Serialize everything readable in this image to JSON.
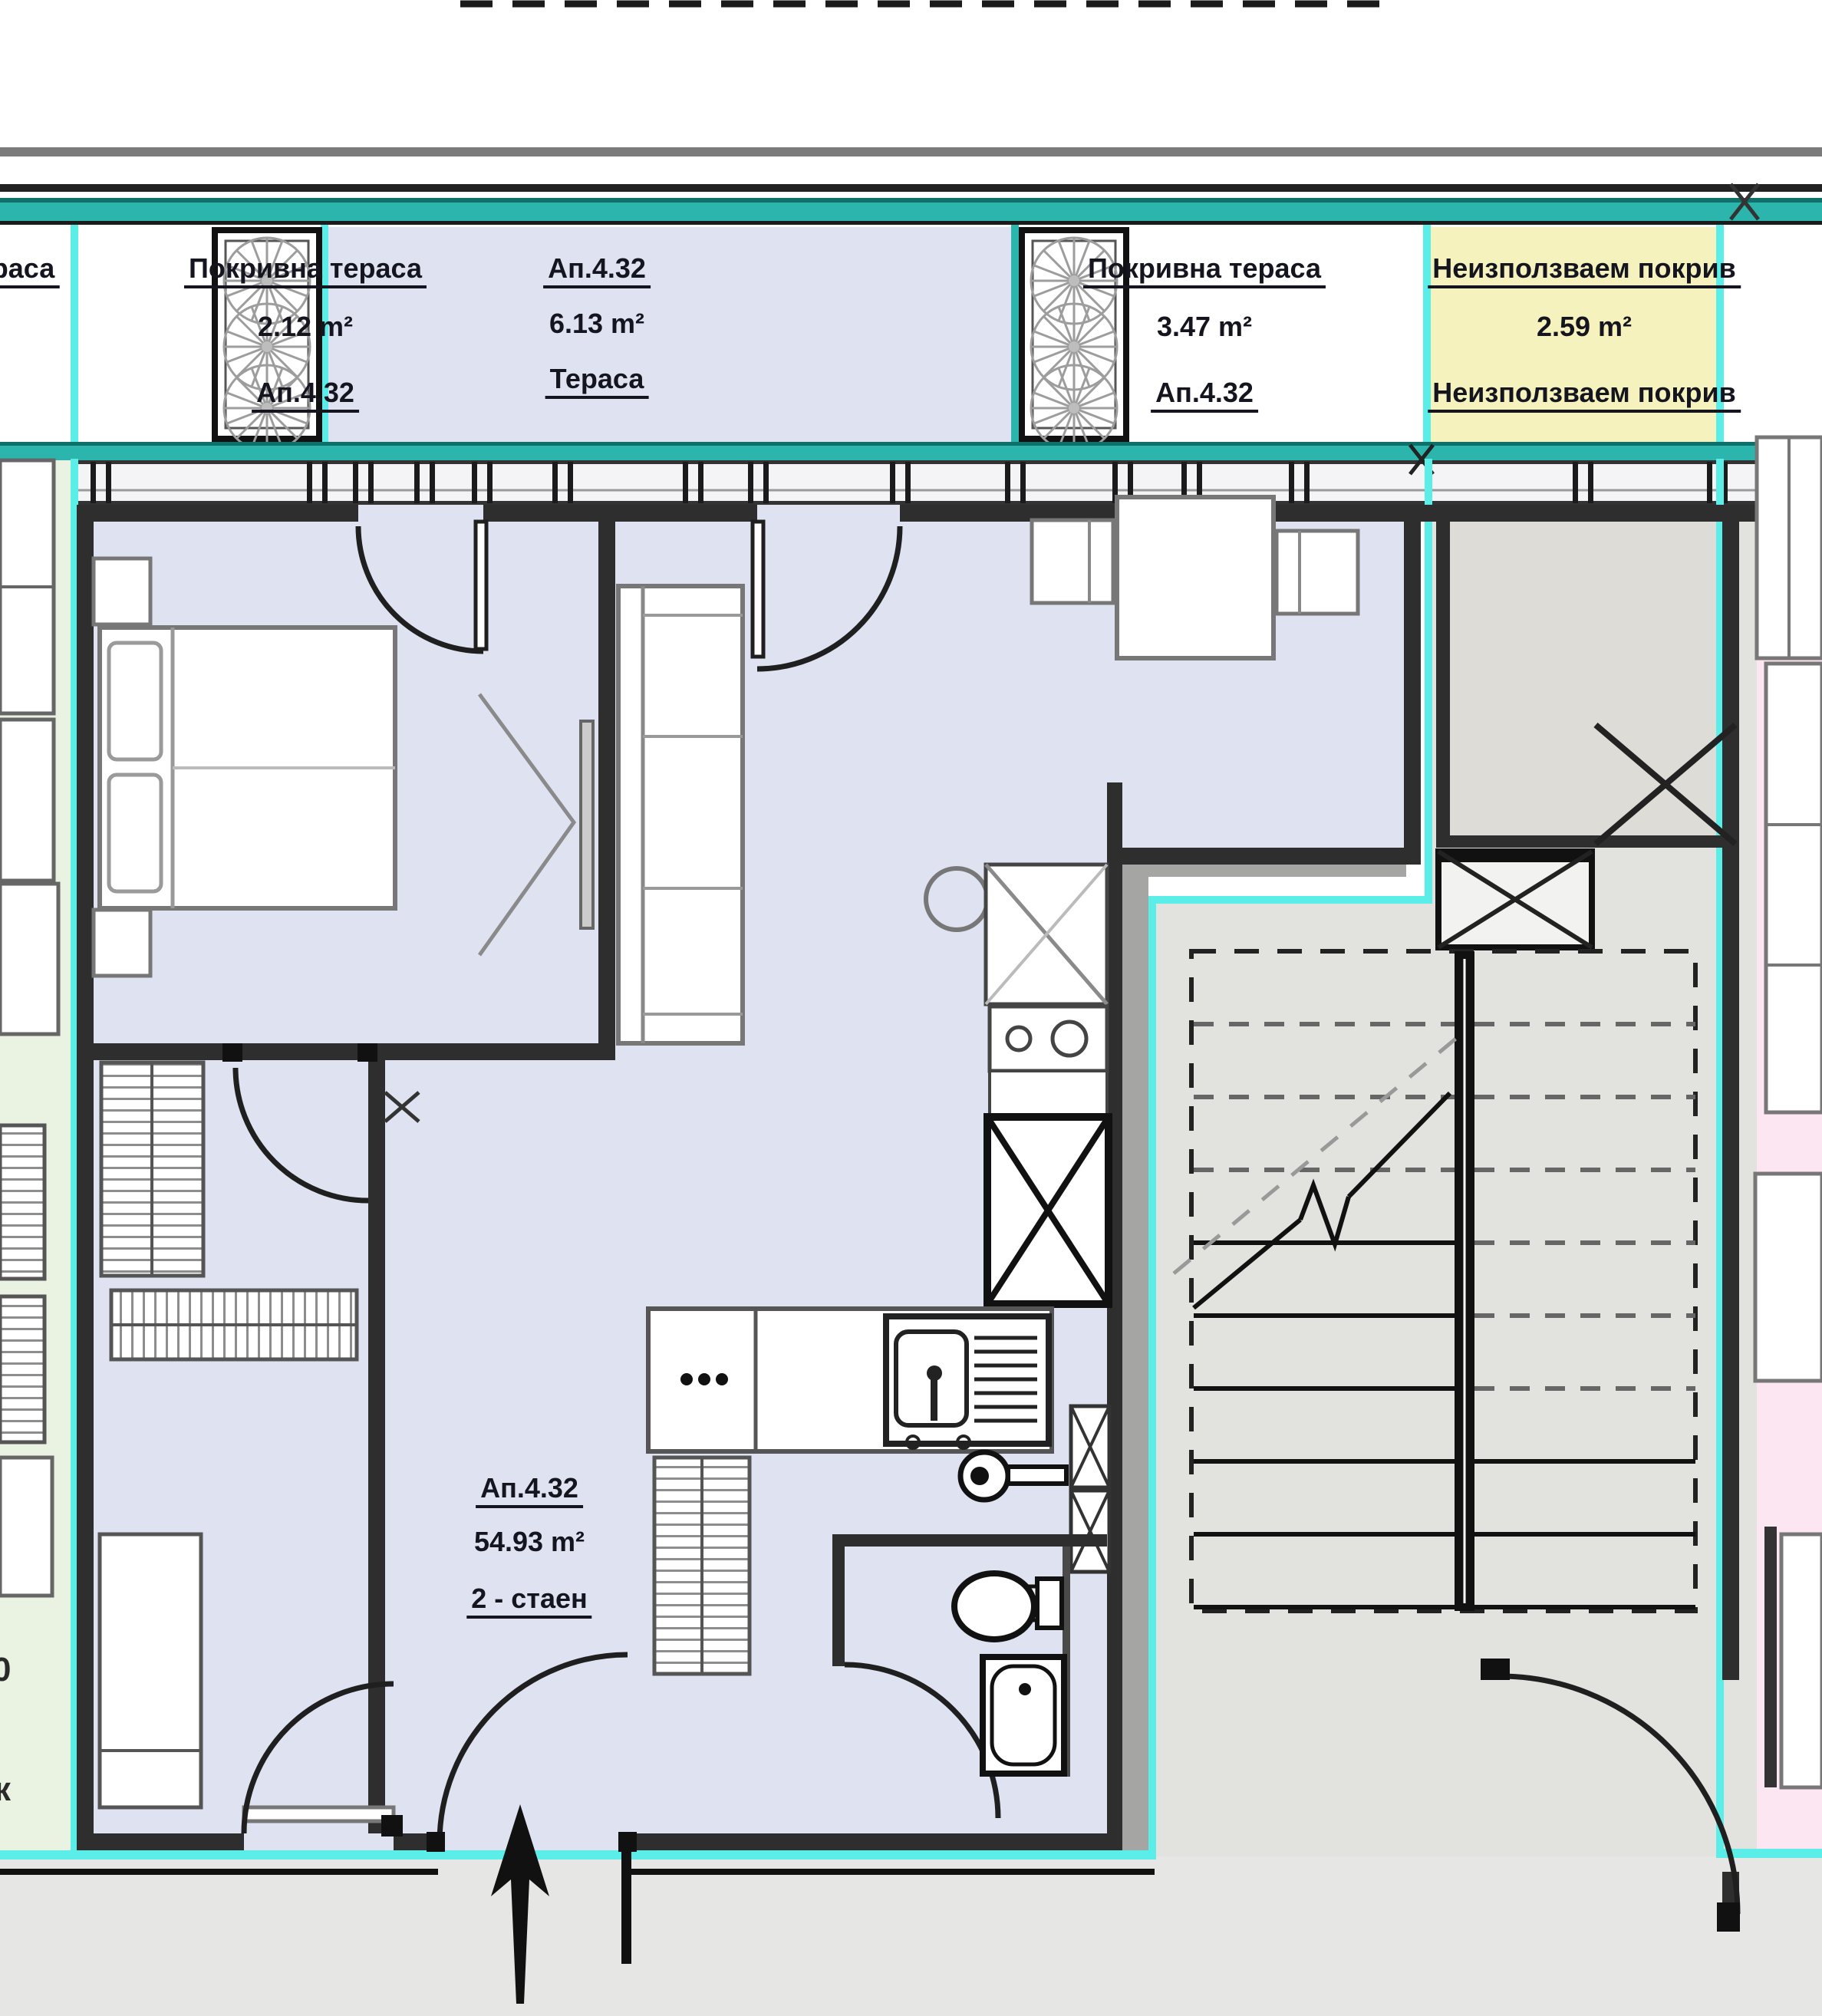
{
  "colors": {
    "apartment_fill": "#dfe3f1",
    "terrace_fill": "#dfe3f1",
    "roof_unused_fill": "#f5f2bd",
    "neighbor_left_fill": "#eaf3e2",
    "neighbor_right_fill": "#fbe6f2",
    "stair_fill": "#e2e2df",
    "landing_fill": "#e6e6e4",
    "outline_teal": "#2cb5ad",
    "outline_cyan": "#5beee8",
    "wall": "#2e2e2e"
  },
  "roof_strip": {
    "left_partial": {
      "text": "раса"
    },
    "terrace1": {
      "title": "Покривна тераса",
      "area": "2.12 m²",
      "unit": "Ап.4.32"
    },
    "terrace_main": {
      "unit": "Ап.4.32",
      "area": "6.13 m²",
      "title": "Тераса"
    },
    "terrace2": {
      "title": "Покривна тераса",
      "area": "3.47 m²",
      "unit": "Ап.4.32"
    },
    "roof_unused": {
      "title": "Неизползваем покрив",
      "area": "2.59 m²",
      "subtitle": "Неизползваем покрив"
    }
  },
  "apartment": {
    "unit": "Ап.4.32",
    "area": "54.93 m²",
    "type": "2 - стаен"
  },
  "neighbor_labels": {
    "mid": "0",
    "bottom": "к"
  }
}
